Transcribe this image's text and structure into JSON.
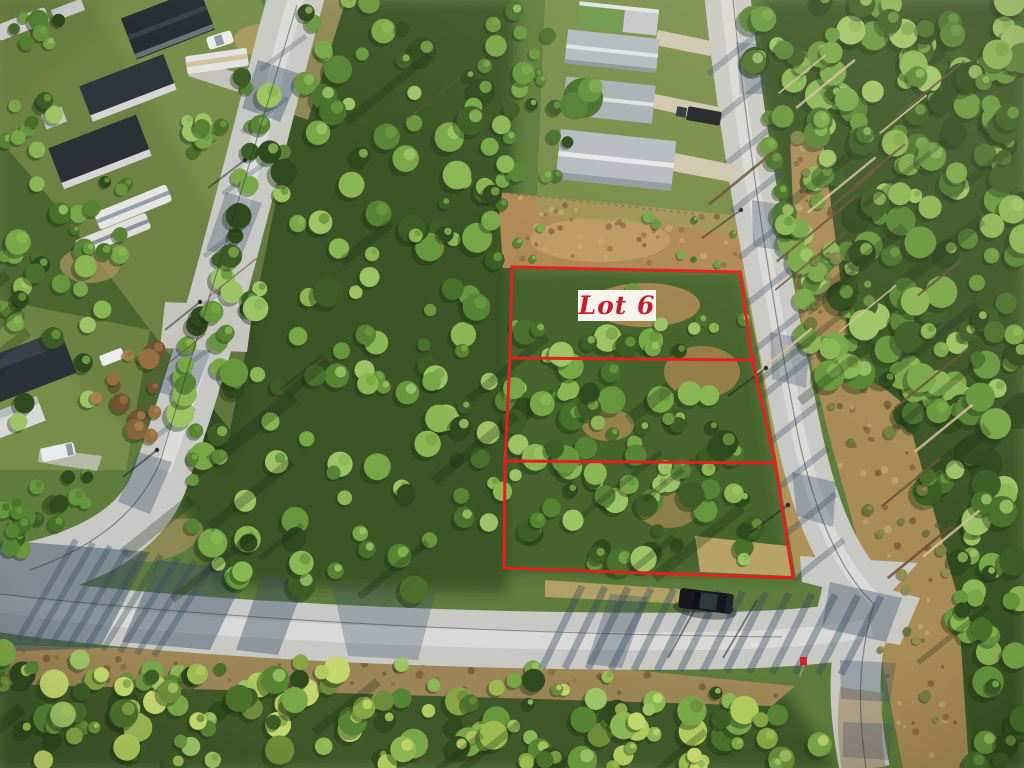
{
  "scene": {
    "type": "aerial-drone-photo",
    "subject": "Wooded vacant residential lots outlined in red between paved roads, houses and RVs at upper left, pine forest at right",
    "overlay": {
      "lot_label": "Lot 6",
      "outlined_sections": 3,
      "outline_color": "#e2201f",
      "label_background": "#f7f4ed",
      "label_text_color": "#c0202f"
    }
  }
}
